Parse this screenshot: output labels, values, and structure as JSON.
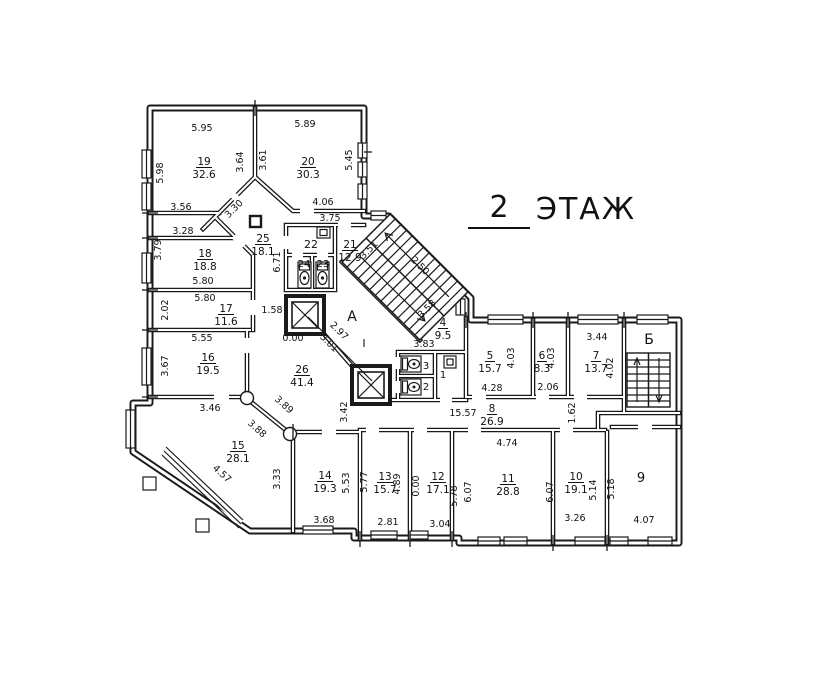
{
  "title": {
    "floor_number": "2",
    "floor_word": "ЭТАЖ"
  },
  "colors": {
    "ink": "#1a1a1a",
    "background": "#ffffff"
  },
  "rooms": [
    {
      "n": "19",
      "a": "32.6",
      "x": 204,
      "y": 165
    },
    {
      "n": "20",
      "a": "30.3",
      "x": 308,
      "y": 165
    },
    {
      "n": "25",
      "a": "18.1",
      "x": 263,
      "y": 242
    },
    {
      "n": "21",
      "a": "12.9",
      "x": 350,
      "y": 248
    },
    {
      "n": "18",
      "a": "18.8",
      "x": 205,
      "y": 257
    },
    {
      "n": "17",
      "a": "11.6",
      "x": 226,
      "y": 312
    },
    {
      "n": "16",
      "a": "19.5",
      "x": 208,
      "y": 361
    },
    {
      "n": "26",
      "a": "41.4",
      "x": 302,
      "y": 373
    },
    {
      "n": "15",
      "a": "28.1",
      "x": 238,
      "y": 449
    },
    {
      "n": "4",
      "a": "9.5",
      "x": 443,
      "y": 326
    },
    {
      "n": "5",
      "a": "15.7",
      "x": 490,
      "y": 359
    },
    {
      "n": "6",
      "a": "8.3",
      "x": 542,
      "y": 359
    },
    {
      "n": "7",
      "a": "13.7",
      "x": 596,
      "y": 359
    },
    {
      "n": "8",
      "a": "26.9",
      "x": 492,
      "y": 412
    },
    {
      "n": "14",
      "a": "19.3",
      "x": 325,
      "y": 479
    },
    {
      "n": "13",
      "a": "15.7",
      "x": 385,
      "y": 480
    },
    {
      "n": "12",
      "a": "17.1",
      "x": 438,
      "y": 480
    },
    {
      "n": "11",
      "a": "28.8",
      "x": 508,
      "y": 482
    },
    {
      "n": "10",
      "a": "19.1",
      "x": 576,
      "y": 480
    }
  ],
  "plain_labels": [
    {
      "t": "22",
      "x": 311,
      "y": 248,
      "s": 11
    },
    {
      "t": "24",
      "x": 304,
      "y": 267,
      "s": 10
    },
    {
      "t": "23",
      "x": 323,
      "y": 267,
      "s": 10
    },
    {
      "t": "3",
      "x": 426,
      "y": 369,
      "s": 10
    },
    {
      "t": "2",
      "x": 426,
      "y": 390,
      "s": 10
    },
    {
      "t": "1",
      "x": 443,
      "y": 378,
      "s": 10
    },
    {
      "t": "9",
      "x": 641,
      "y": 482,
      "s": 13
    },
    {
      "t": "А",
      "x": 352,
      "y": 321,
      "s": 14
    },
    {
      "t": "I",
      "x": 364,
      "y": 347,
      "s": 11
    },
    {
      "t": "Б",
      "x": 649,
      "y": 344,
      "s": 14
    }
  ],
  "dims": [
    {
      "t": "5.95",
      "x": 202,
      "y": 131,
      "r": 0
    },
    {
      "t": "5.89",
      "x": 305,
      "y": 127,
      "r": 0
    },
    {
      "t": "5.98",
      "x": 163,
      "y": 173,
      "r": -90
    },
    {
      "t": "3.64",
      "x": 243,
      "y": 162,
      "r": -90
    },
    {
      "t": "3.61",
      "x": 266,
      "y": 160,
      "r": -90
    },
    {
      "t": "5.45",
      "x": 352,
      "y": 160,
      "r": -90
    },
    {
      "t": "4.06",
      "x": 323,
      "y": 205,
      "r": 0
    },
    {
      "t": "3.56",
      "x": 181,
      "y": 210,
      "r": 0
    },
    {
      "t": "3.75",
      "x": 330,
      "y": 221,
      "r": 0
    },
    {
      "t": "3.28",
      "x": 183,
      "y": 234,
      "r": 0
    },
    {
      "t": "3.30",
      "x": 236,
      "y": 211,
      "r": -45
    },
    {
      "t": "3.79",
      "x": 161,
      "y": 250,
      "r": -90
    },
    {
      "t": "6.71",
      "x": 280,
      "y": 262,
      "r": -90
    },
    {
      "t": "3.51",
      "x": 371,
      "y": 252,
      "r": -45
    },
    {
      "t": "2.50",
      "x": 418,
      "y": 268,
      "r": 45
    },
    {
      "t": "3.58",
      "x": 429,
      "y": 311,
      "r": -45
    },
    {
      "t": "5.80",
      "x": 203,
      "y": 284,
      "r": 0
    },
    {
      "t": "5.80",
      "x": 205,
      "y": 301,
      "r": 0
    },
    {
      "t": "2.02",
      "x": 168,
      "y": 310,
      "r": -90
    },
    {
      "t": "1.58",
      "x": 272,
      "y": 313,
      "r": 0
    },
    {
      "t": "0.00",
      "x": 293,
      "y": 341,
      "r": 0
    },
    {
      "t": "2.97",
      "x": 337,
      "y": 333,
      "r": 45
    },
    {
      "t": "3.01",
      "x": 327,
      "y": 345,
      "r": 45
    },
    {
      "t": "5.55",
      "x": 202,
      "y": 341,
      "r": 0
    },
    {
      "t": "3.67",
      "x": 168,
      "y": 366,
      "r": -90
    },
    {
      "t": "3.83",
      "x": 424,
      "y": 347,
      "r": 0
    },
    {
      "t": "3.46",
      "x": 210,
      "y": 411,
      "r": 0
    },
    {
      "t": "3.89",
      "x": 282,
      "y": 407,
      "r": 42
    },
    {
      "t": "3.88",
      "x": 255,
      "y": 431,
      "r": 42
    },
    {
      "t": "3.42",
      "x": 347,
      "y": 412,
      "r": -90
    },
    {
      "t": "4.03",
      "x": 514,
      "y": 358,
      "r": -90
    },
    {
      "t": "4.03",
      "x": 554,
      "y": 358,
      "r": -90
    },
    {
      "t": "3.44",
      "x": 597,
      "y": 340,
      "r": 0
    },
    {
      "t": "4.02",
      "x": 613,
      "y": 368,
      "r": -90
    },
    {
      "t": "4.28",
      "x": 492,
      "y": 391,
      "r": 0
    },
    {
      "t": "2.06",
      "x": 548,
      "y": 390,
      "r": 0
    },
    {
      "t": "15.57",
      "x": 463,
      "y": 416,
      "r": 0
    },
    {
      "t": "1.62",
      "x": 575,
      "y": 413,
      "r": -90
    },
    {
      "t": "4.74",
      "x": 507,
      "y": 446,
      "r": 0
    },
    {
      "t": "4.57",
      "x": 220,
      "y": 476,
      "r": 42
    },
    {
      "t": "3.33",
      "x": 280,
      "y": 479,
      "r": -90
    },
    {
      "t": "5.53",
      "x": 349,
      "y": 483,
      "r": -90
    },
    {
      "t": "5.77",
      "x": 367,
      "y": 482,
      "r": -90
    },
    {
      "t": "4.89",
      "x": 400,
      "y": 484,
      "r": -90
    },
    {
      "t": "0.00",
      "x": 419,
      "y": 486,
      "r": -90
    },
    {
      "t": "5.78",
      "x": 457,
      "y": 496,
      "r": -90
    },
    {
      "t": "6.07",
      "x": 471,
      "y": 492,
      "r": -90
    },
    {
      "t": "6.07",
      "x": 553,
      "y": 492,
      "r": -90
    },
    {
      "t": "5.14",
      "x": 596,
      "y": 490,
      "r": -90
    },
    {
      "t": "5.18",
      "x": 614,
      "y": 489,
      "r": -90
    },
    {
      "t": "3.68",
      "x": 324,
      "y": 523,
      "r": 0
    },
    {
      "t": "2.81",
      "x": 388,
      "y": 525,
      "r": 0
    },
    {
      "t": "3.04",
      "x": 440,
      "y": 527,
      "r": 0
    },
    {
      "t": "3.26",
      "x": 575,
      "y": 521,
      "r": 0
    },
    {
      "t": "4.07",
      "x": 644,
      "y": 523,
      "r": 0
    }
  ]
}
